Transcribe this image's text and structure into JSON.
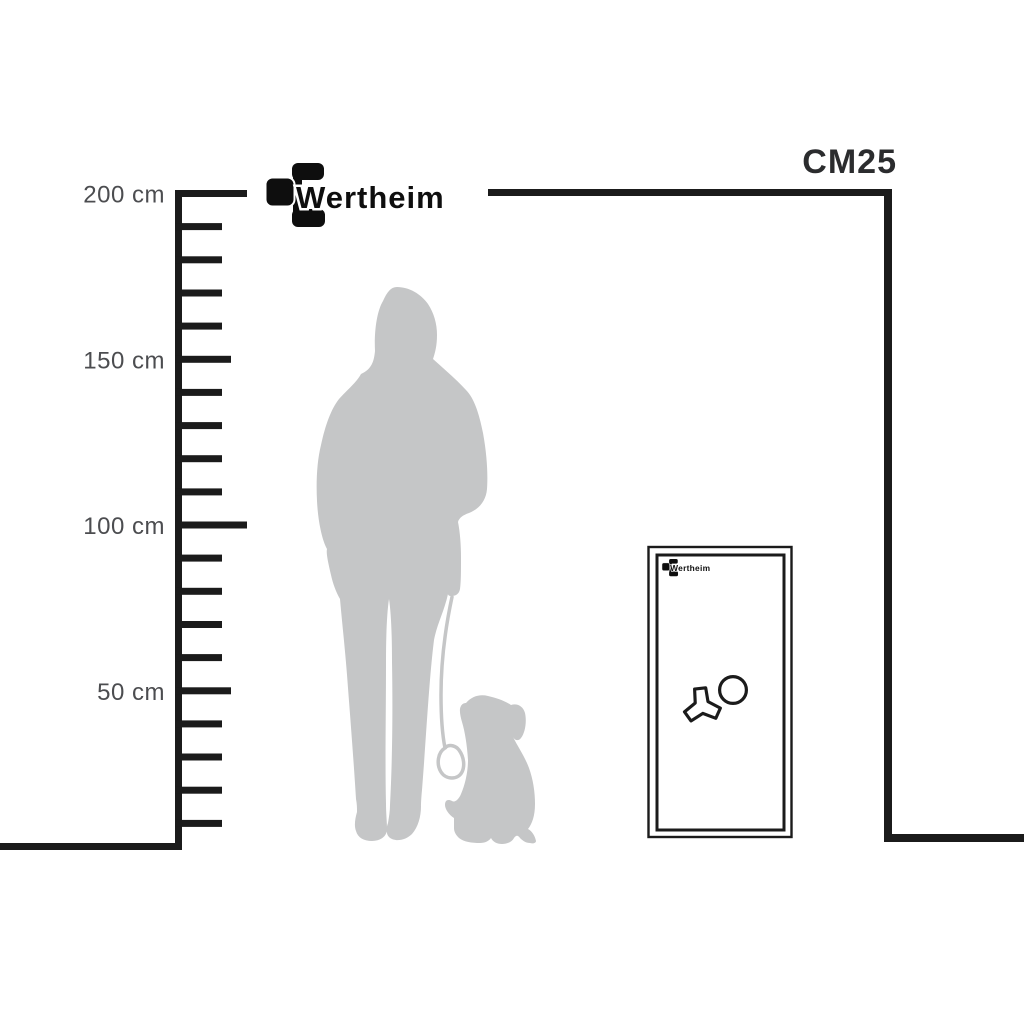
{
  "header": {
    "brand": "Wertheim",
    "model_label": "CM25"
  },
  "ruler": {
    "unit": "cm",
    "min_cm": 10,
    "max_cm": 200,
    "step_cm": 10,
    "labels": [
      {
        "cm": 200,
        "text": "200 cm"
      },
      {
        "cm": 150,
        "text": "150 cm"
      },
      {
        "cm": 100,
        "text": "100 cm"
      },
      {
        "cm": 50,
        "text": "50 cm"
      }
    ]
  },
  "safe": {
    "door_brand_label": "Wertheim",
    "icons": [
      "three-spoke-handle-icon",
      "dial-knob-icon"
    ]
  },
  "silhouettes": {
    "person": "standing-woman-with-leash",
    "dog": "sitting-dog-looking-up"
  },
  "colors": {
    "background": "#ffffff",
    "line": "#1b1b1b",
    "label_text": "#4c4d50",
    "model_text": "#2b2c2e",
    "logo_black": "#0e0e0e",
    "silhouette": "#c5c6c7"
  }
}
